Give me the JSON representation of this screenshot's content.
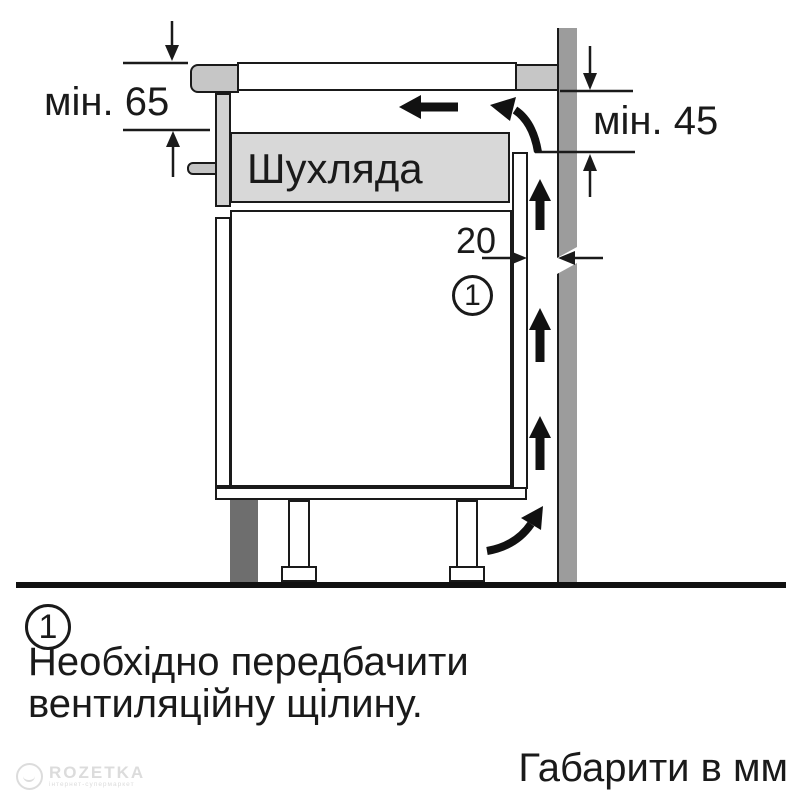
{
  "diagram": {
    "labels": {
      "min_left": "мін. 65",
      "min_right": "мін. 45",
      "gap": "20",
      "drawer": "Шухляда",
      "callout": "1"
    },
    "colors": {
      "line": "#1a1a1a",
      "wall_gray": "#9c9c9c",
      "worktop_gray": "#c6c6c6",
      "drawer_gray": "#d8d8d8",
      "front_panel_gray": "#d2d2d2",
      "plinth_dark": "#6e6e6e",
      "watermark_gray": "#dcdcdc"
    }
  },
  "legend": {
    "marker": "1",
    "text_line1": "Необхідно передбачити",
    "text_line2": "вентиляційну щілину."
  },
  "footer": {
    "units_note": "Габарити в мм"
  },
  "watermark": {
    "brand": "ROZETKA",
    "tagline": "інтернет-супермаркет"
  }
}
